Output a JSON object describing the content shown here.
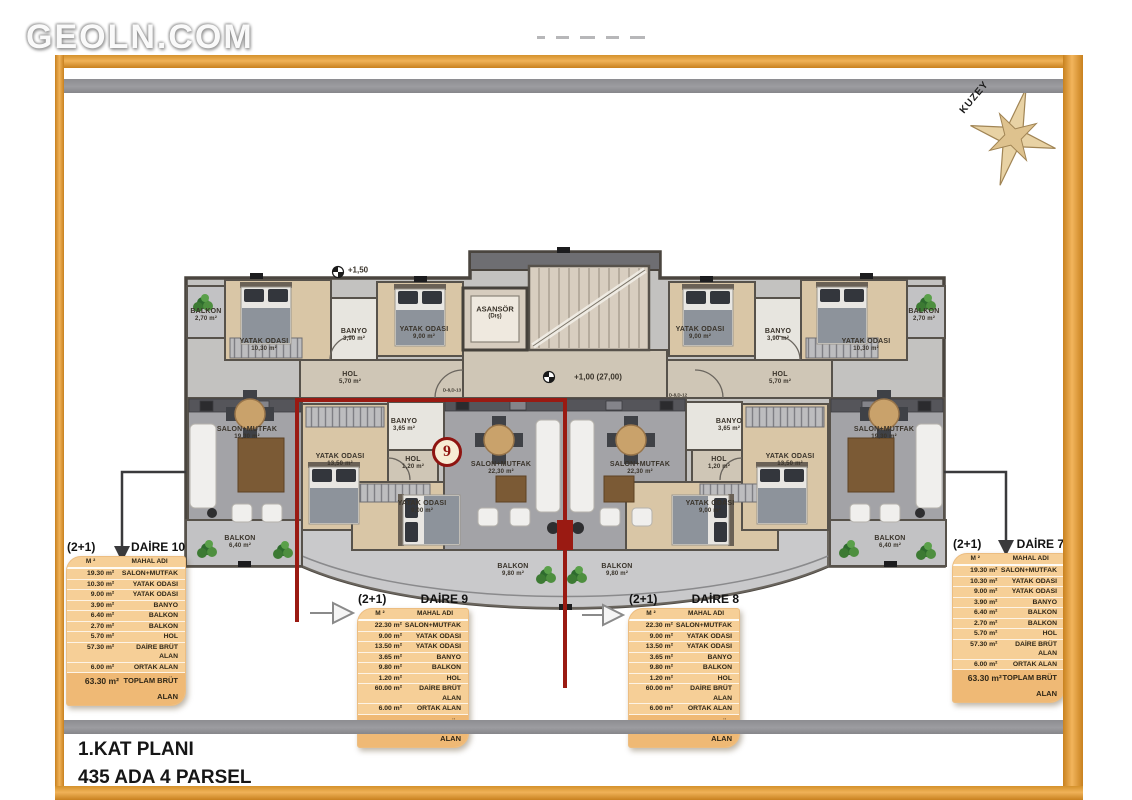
{
  "watermark": "GEOLN.COM",
  "compass": {
    "label": "KUZEY"
  },
  "footer": {
    "line1": "1.KAT PLANI",
    "line2": "435 ADA 4 PARSEL"
  },
  "badge": {
    "number": "9"
  },
  "core": {
    "elevator": "ASANSÖR",
    "elevator_note": "(Dış)",
    "elev_top": "+1,50",
    "elev_mid": "+1,00 (27,00)",
    "door_tag_left": "D-8,D-13",
    "door_tag_right": "D-8,D-12"
  },
  "plan": {
    "rooms": [
      {
        "name": "BALKON",
        "area": "2,70 m²",
        "x": 206,
        "y": 316
      },
      {
        "name": "YATAK ODASI",
        "area": "10,30 m²",
        "x": 264,
        "y": 346
      },
      {
        "name": "BANYO",
        "area": "3,90 m²",
        "x": 354,
        "y": 336
      },
      {
        "name": "YATAK ODASI",
        "area": "9,00 m²",
        "x": 424,
        "y": 334
      },
      {
        "name": "HOL",
        "area": "5,70 m²",
        "x": 350,
        "y": 379
      },
      {
        "name": "SALON+MUTFAK",
        "area": "19,30 m²",
        "x": 247,
        "y": 434
      },
      {
        "name": "BALKON",
        "area": "6,40 m²",
        "x": 240,
        "y": 543
      },
      {
        "name": "YATAK ODASI",
        "area": "13,50 m²",
        "x": 340,
        "y": 461
      },
      {
        "name": "BANYO",
        "area": "3,65 m²",
        "x": 404,
        "y": 426
      },
      {
        "name": "HOL",
        "area": "1,20 m²",
        "x": 413,
        "y": 464
      },
      {
        "name": "YATAK ODASI",
        "area": "9,00 m²",
        "x": 422,
        "y": 508
      },
      {
        "name": "SALON+MUTFAK",
        "area": "22,30 m²",
        "x": 501,
        "y": 469
      },
      {
        "name": "BALKON",
        "area": "9,80 m²",
        "x": 513,
        "y": 571
      },
      {
        "name": "SALON+MUTFAK",
        "area": "22,30 m²",
        "x": 640,
        "y": 469
      },
      {
        "name": "BANYO",
        "area": "3,65 m²",
        "x": 729,
        "y": 426
      },
      {
        "name": "HOL",
        "area": "1,20 m²",
        "x": 719,
        "y": 464
      },
      {
        "name": "YATAK ODASI",
        "area": "9,00 m²",
        "x": 710,
        "y": 508
      },
      {
        "name": "YATAK ODASI",
        "area": "13,50 m²",
        "x": 790,
        "y": 461
      },
      {
        "name": "BALKON",
        "area": "9,80 m²",
        "x": 617,
        "y": 571
      },
      {
        "name": "YATAK ODASI",
        "area": "9,00 m²",
        "x": 700,
        "y": 334
      },
      {
        "name": "BANYO",
        "area": "3,90 m²",
        "x": 778,
        "y": 336
      },
      {
        "name": "YATAK ODASI",
        "area": "10,30 m²",
        "x": 866,
        "y": 346
      },
      {
        "name": "BALKON",
        "area": "2,70 m²",
        "x": 924,
        "y": 316
      },
      {
        "name": "HOL",
        "area": "5,70 m²",
        "x": 780,
        "y": 379
      },
      {
        "name": "SALON+MUTFAK",
        "area": "19,30 m²",
        "x": 884,
        "y": 434
      },
      {
        "name": "BALKON",
        "area": "6,40 m²",
        "x": 890,
        "y": 543
      }
    ]
  },
  "tables": [
    {
      "type": "(2+1)",
      "title": "DAİRE 10",
      "cols": {
        "m2": "M ²",
        "name": "MAHAL ADI"
      },
      "rows": [
        [
          "19.30 m²",
          "SALON+MUTFAK"
        ],
        [
          "10.30 m²",
          "YATAK ODASI"
        ],
        [
          "9.00 m²",
          "YATAK ODASI"
        ],
        [
          "3.90 m²",
          "BANYO"
        ],
        [
          "6.40 m²",
          "BALKON"
        ],
        [
          "2.70 m²",
          "BALKON"
        ],
        [
          "5.70 m²",
          "HOL"
        ],
        [
          "57.30 m²",
          "DAİRE BRÜT ALAN"
        ],
        [
          "6.00 m²",
          "ORTAK ALAN"
        ]
      ],
      "total": [
        "63.30 m²",
        "TOPLAM BRÜT ALAN"
      ]
    },
    {
      "type": "(2+1)",
      "title": "DAİRE 9",
      "cols": {
        "m2": "M ²",
        "name": "MAHAL ADI"
      },
      "rows": [
        [
          "22.30 m²",
          "SALON+MUTFAK"
        ],
        [
          "9.00 m²",
          "YATAK ODASI"
        ],
        [
          "13.50 m²",
          "YATAK ODASI"
        ],
        [
          "3.65 m²",
          "BANYO"
        ],
        [
          "9.80 m²",
          "BALKON"
        ],
        [
          "1.20 m²",
          "HOL"
        ],
        [
          "60.00 m²",
          "DAİRE BRÜT ALAN"
        ],
        [
          "6.00 m²",
          "ORTAK ALAN"
        ]
      ],
      "total": [
        "66.00 m²",
        "TOPLAM BRÜT ALAN"
      ]
    },
    {
      "type": "(2+1)",
      "title": "DAİRE 8",
      "cols": {
        "m2": "M ²",
        "name": "MAHAL ADI"
      },
      "rows": [
        [
          "22.30 m²",
          "SALON+MUTFAK"
        ],
        [
          "9.00 m²",
          "YATAK ODASI"
        ],
        [
          "13.50 m²",
          "YATAK ODASI"
        ],
        [
          "3.65 m²",
          "BANYO"
        ],
        [
          "9.80 m²",
          "BALKON"
        ],
        [
          "1.20 m²",
          "HOL"
        ],
        [
          "60.00 m²",
          "DAİRE BRÜT ALAN"
        ],
        [
          "6.00 m²",
          "ORTAK ALAN"
        ]
      ],
      "total": [
        "66.00 m²",
        "TOPLAM BRÜT ALAN"
      ]
    },
    {
      "type": "(2+1)",
      "title": "DAİRE 7",
      "cols": {
        "m2": "M ²",
        "name": "MAHAL ADI"
      },
      "rows": [
        [
          "19.30 m²",
          "SALON+MUTFAK"
        ],
        [
          "10.30 m²",
          "YATAK ODASI"
        ],
        [
          "9.00 m²",
          "YATAK ODASI"
        ],
        [
          "3.90 m²",
          "BANYO"
        ],
        [
          "6.40 m²",
          "BALKON"
        ],
        [
          "2.70 m²",
          "BALKON"
        ],
        [
          "5.70 m²",
          "HOL"
        ],
        [
          "57.30 m²",
          "DAİRE BRÜT ALAN"
        ],
        [
          "6.00 m²",
          "ORTAK ALAN"
        ]
      ],
      "total": [
        "63.30 m²",
        "TOPLAM BRÜT ALAN"
      ]
    }
  ],
  "colors": {
    "frame_orange": "#e8a33d",
    "accent_red": "#9a1a12",
    "table_tan": "#f6cf97",
    "bar_gray": "#95959a"
  }
}
